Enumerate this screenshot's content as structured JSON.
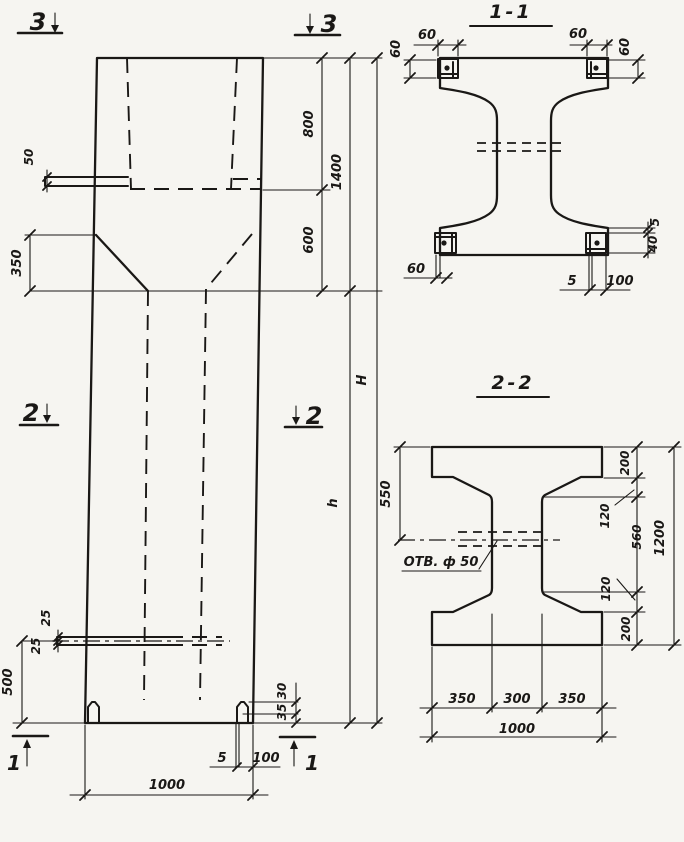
{
  "sheet": {
    "bg": "#f6f5f1",
    "ink": "#1a1816"
  },
  "elevation": {
    "marker3": "3",
    "marker2": "2",
    "marker1": "1",
    "d50": "50",
    "d350": "350",
    "d800": "800",
    "d600": "600",
    "d1400": "1400",
    "dH": "H",
    "dh": "h",
    "d25_upper": "25",
    "d25_lower": "25",
    "d500": "500",
    "d30": "30",
    "d35": "35",
    "d5": "5",
    "d100": "100",
    "d1000": "1000"
  },
  "section_1_1": {
    "title": "1-1",
    "d60": "60",
    "d5": "5",
    "d40": "40",
    "d100": "100"
  },
  "section_2_2": {
    "title": "2-2",
    "hole_label": "ОТВ. ф 50",
    "d550": "550",
    "d200": "200",
    "d120": "120",
    "d560": "560",
    "d1200": "1200",
    "d350": "350",
    "d300": "300",
    "d1000": "1000"
  }
}
